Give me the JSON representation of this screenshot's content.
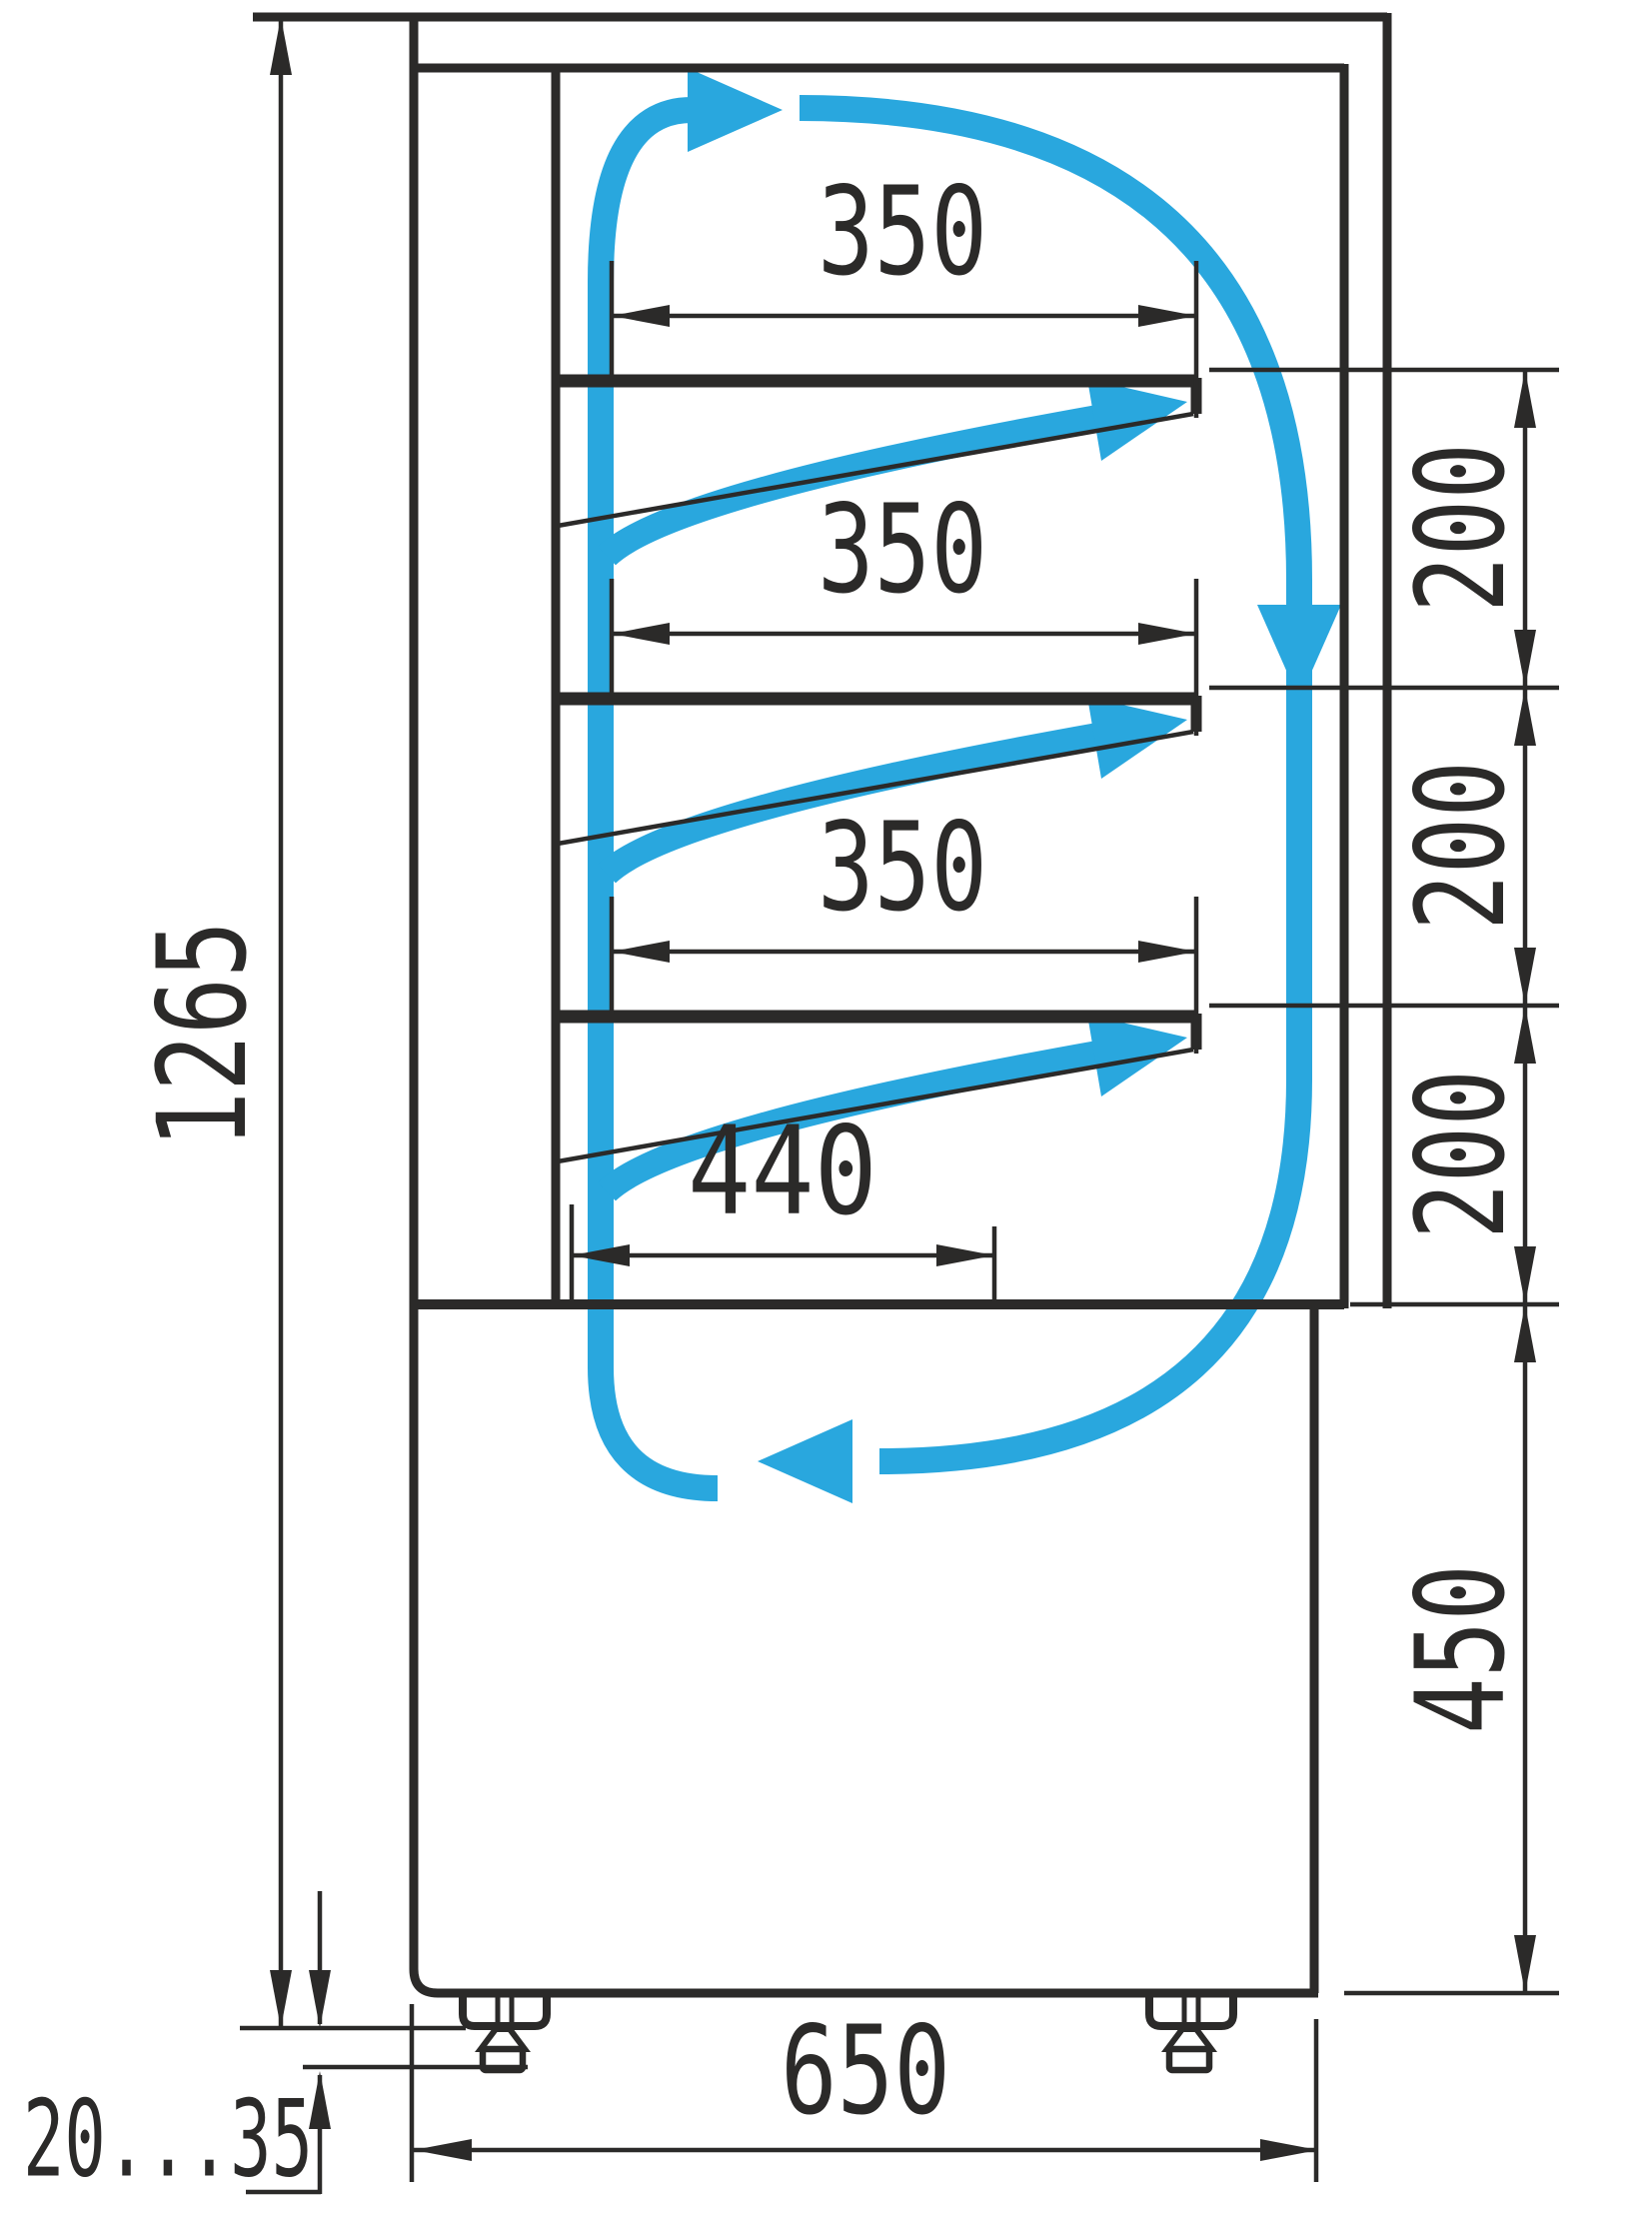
{
  "drawing": {
    "kind": "refrigerated display case side-section with airflow",
    "units": "mm"
  },
  "colors": {
    "ink": "#2b2a29",
    "flow_blue": "#29a7de",
    "background": "#ffffff"
  },
  "dimensions": {
    "overall_height": "1265",
    "shelves": [
      {
        "depth": "350"
      },
      {
        "depth": "350"
      },
      {
        "depth": "350"
      }
    ],
    "bottom_deck_depth": "440",
    "shelf_spacing": [
      "200",
      "200",
      "200"
    ],
    "base_section_height": "450",
    "base_depth": "650",
    "leg_adjust_range": "20...35"
  }
}
